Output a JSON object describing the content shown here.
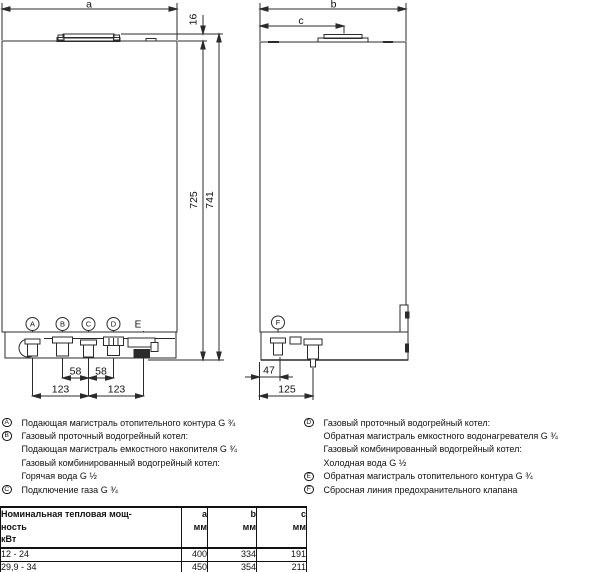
{
  "drawing": {
    "left": {
      "width": "a",
      "flue_height": "16",
      "body_height": "725",
      "total_height": "741",
      "pitch_left": "58",
      "pitch_right": "58",
      "spacing_left": "123",
      "spacing_right": "123",
      "ports": [
        "A",
        "B",
        "C",
        "D",
        "E"
      ]
    },
    "right": {
      "width": "b",
      "flue_pos": "c",
      "offset_f": "47",
      "offset_pipe": "125",
      "port": "F"
    }
  },
  "legend": {
    "left": [
      {
        "marker": "A",
        "text": "Подающая магистраль отопительного контура G ¾"
      },
      {
        "marker": "B",
        "text": "Газовый проточный водогрейный котел:"
      },
      {
        "marker": "",
        "text": "Подающая магистраль емкостного накопителя G ¾"
      },
      {
        "marker": "",
        "text": "Газовый комбинированный водогрейный котел:"
      },
      {
        "marker": "",
        "text": "Горячая вода G ½"
      },
      {
        "marker": "C",
        "text": "Подключение газа G ¾"
      }
    ],
    "right": [
      {
        "marker": "D",
        "text": "Газовый проточный водогрейный котел:"
      },
      {
        "marker": "",
        "text": "Обратная магистраль емкостного водонагревателя G ¾"
      },
      {
        "marker": "",
        "text": "Газовый комбинированный водогрейный котел:"
      },
      {
        "marker": "",
        "text": "Холодная вода G ½"
      },
      {
        "marker": "E",
        "text": "Обратная магистраль отопительного контура G ¾"
      },
      {
        "marker": "F",
        "text": "Сбросная линия предохранительного клапана"
      }
    ]
  },
  "table": {
    "header": {
      "name": "Номинальная тепловая мощ-\nность\nкВт",
      "a": "a\nмм",
      "b": "b\nмм",
      "c": "c\nмм"
    },
    "rows": [
      {
        "name": "12 - 24",
        "a": "400",
        "b": "334",
        "c": "191"
      },
      {
        "name": "29,9 - 34",
        "a": "450",
        "b": "354",
        "c": "211"
      }
    ]
  }
}
